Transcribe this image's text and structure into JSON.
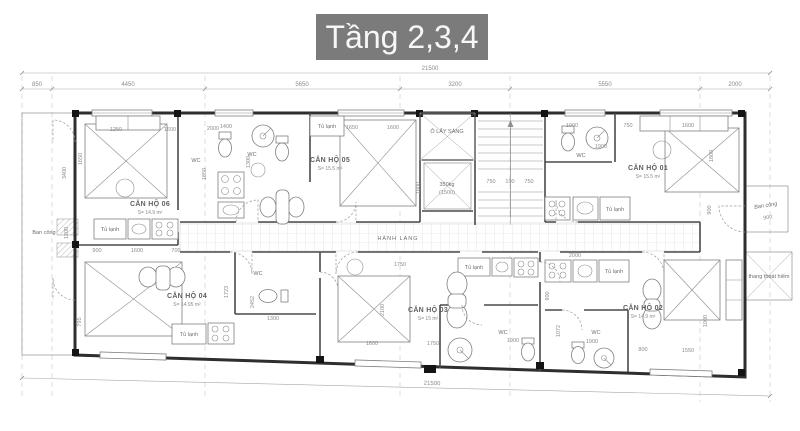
{
  "title": "Tầng 2,3,4",
  "colors": {
    "title_bg": "#7b7b7b",
    "title_fg": "#f7f7f7",
    "wall": "#2e2e2e",
    "line": "#8f8f8f",
    "dim_text": "#8c8c8c"
  },
  "plan": {
    "overall_dim_top": "21500",
    "overall_dim_bottom": "21500",
    "axis_dims": [
      "850",
      "4450",
      "5650",
      "3200",
      "5550",
      "2000"
    ],
    "rooms": [
      {
        "name": "CĂN HỘ 01",
        "area": "S= 15.5 m²"
      },
      {
        "name": "CĂN HỘ 02",
        "area": "S= 14.9 m²"
      },
      {
        "name": "CĂN HỘ 03",
        "area": "S= 15 m²"
      },
      {
        "name": "CĂN HỘ 04",
        "area": "S= 14.95 m²"
      },
      {
        "name": "CĂN HỘ 05",
        "area": "S= 15.5 m²"
      },
      {
        "name": "CĂN HỘ 06",
        "area": "S= 14.9 m²"
      }
    ],
    "labels": {
      "corridor": "HÀNH LANG",
      "light_well": "Ô LẤY SÁNG",
      "elevator_capacity": "350kg",
      "elevator_size": "(1500)",
      "balcony": "Ban công",
      "escape_stair": "thang thoát hiểm",
      "wc": "WC",
      "fridge": "Tủ lạnh"
    },
    "stair_dims": [
      "750",
      "100",
      "750"
    ],
    "dim_values": [
      "1250",
      "1600",
      "1400",
      "2000",
      "1300",
      "1650",
      "1600",
      "1850",
      "1000",
      "750",
      "1600",
      "1900",
      "1800",
      "900",
      "900",
      "1600",
      "700",
      "1200",
      "3400",
      "1650",
      "1750",
      "2100",
      "1600",
      "1750",
      "1900",
      "1300",
      "2452",
      "1723",
      "795",
      "1800",
      "1600",
      "1550",
      "800",
      "2000",
      "900",
      "1072",
      "1900",
      "1000",
      "900"
    ]
  }
}
